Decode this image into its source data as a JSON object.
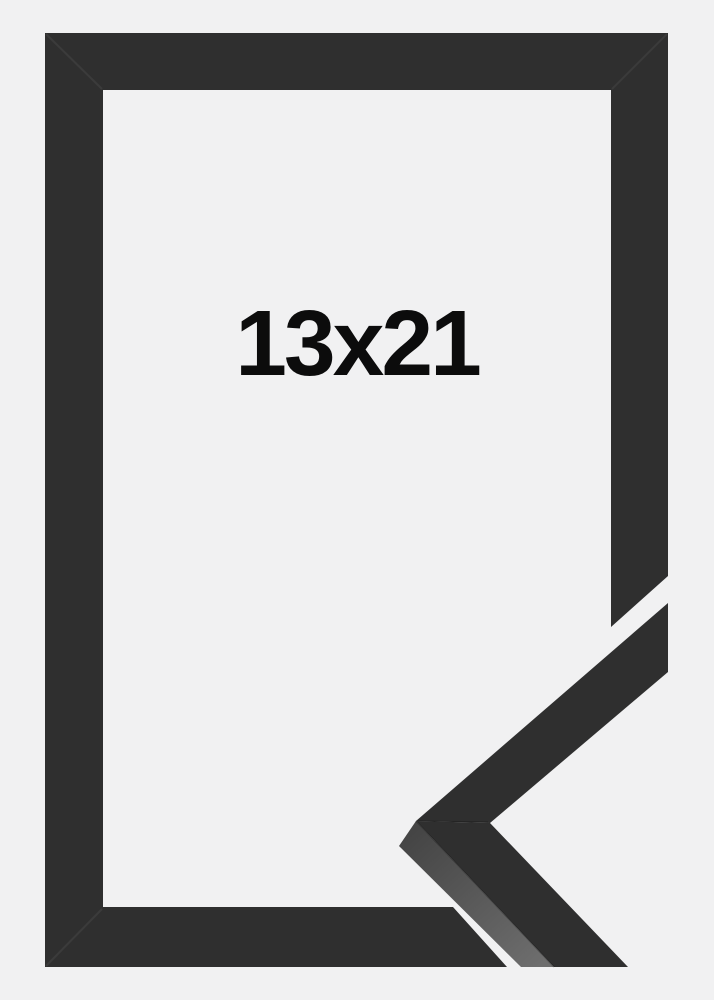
{
  "photo": {
    "size_label": "13x21",
    "colors": {
      "background": "#f1f1f2",
      "frame": "#2f2f2f",
      "moulding_edge_dark": "#454545",
      "moulding_edge_light": "#6e6e6e",
      "label": "#0c0c0c"
    }
  }
}
